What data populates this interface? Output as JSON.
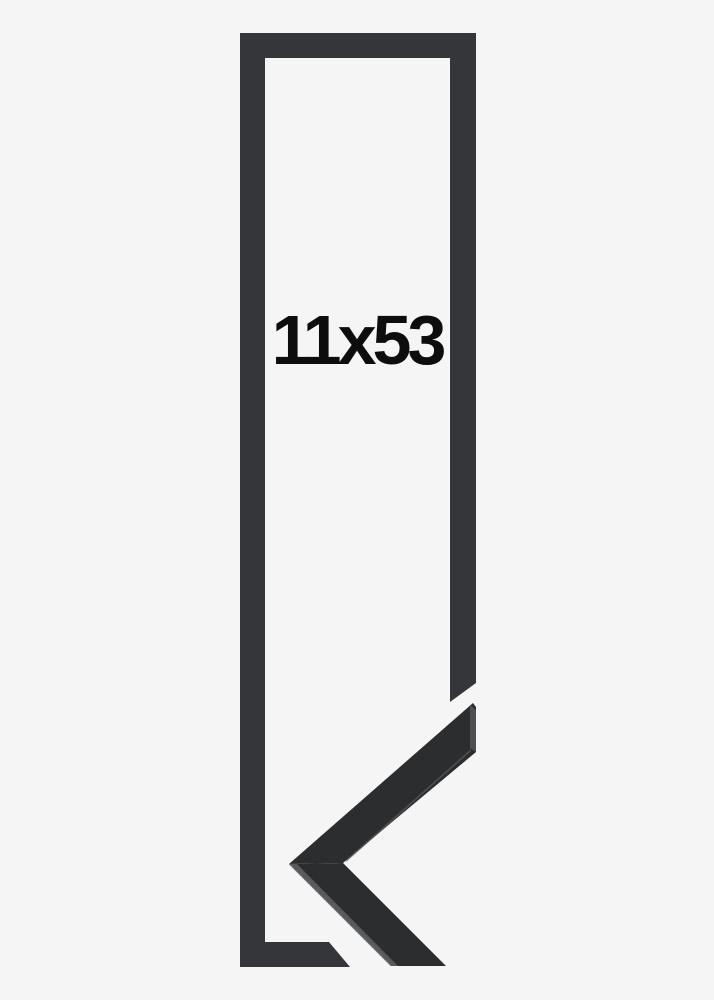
{
  "page": {
    "background": "#f5f5f5"
  },
  "frame": {
    "size_label": "11x53",
    "label_color": "#0d0d0d"
  },
  "colors": {
    "outline": "#353639",
    "moulding_front": "#2c2d2f",
    "moulding_top_face": "#58595c",
    "moulding_end_face": "#4d4f52",
    "edge_highlight": "#86888b"
  }
}
